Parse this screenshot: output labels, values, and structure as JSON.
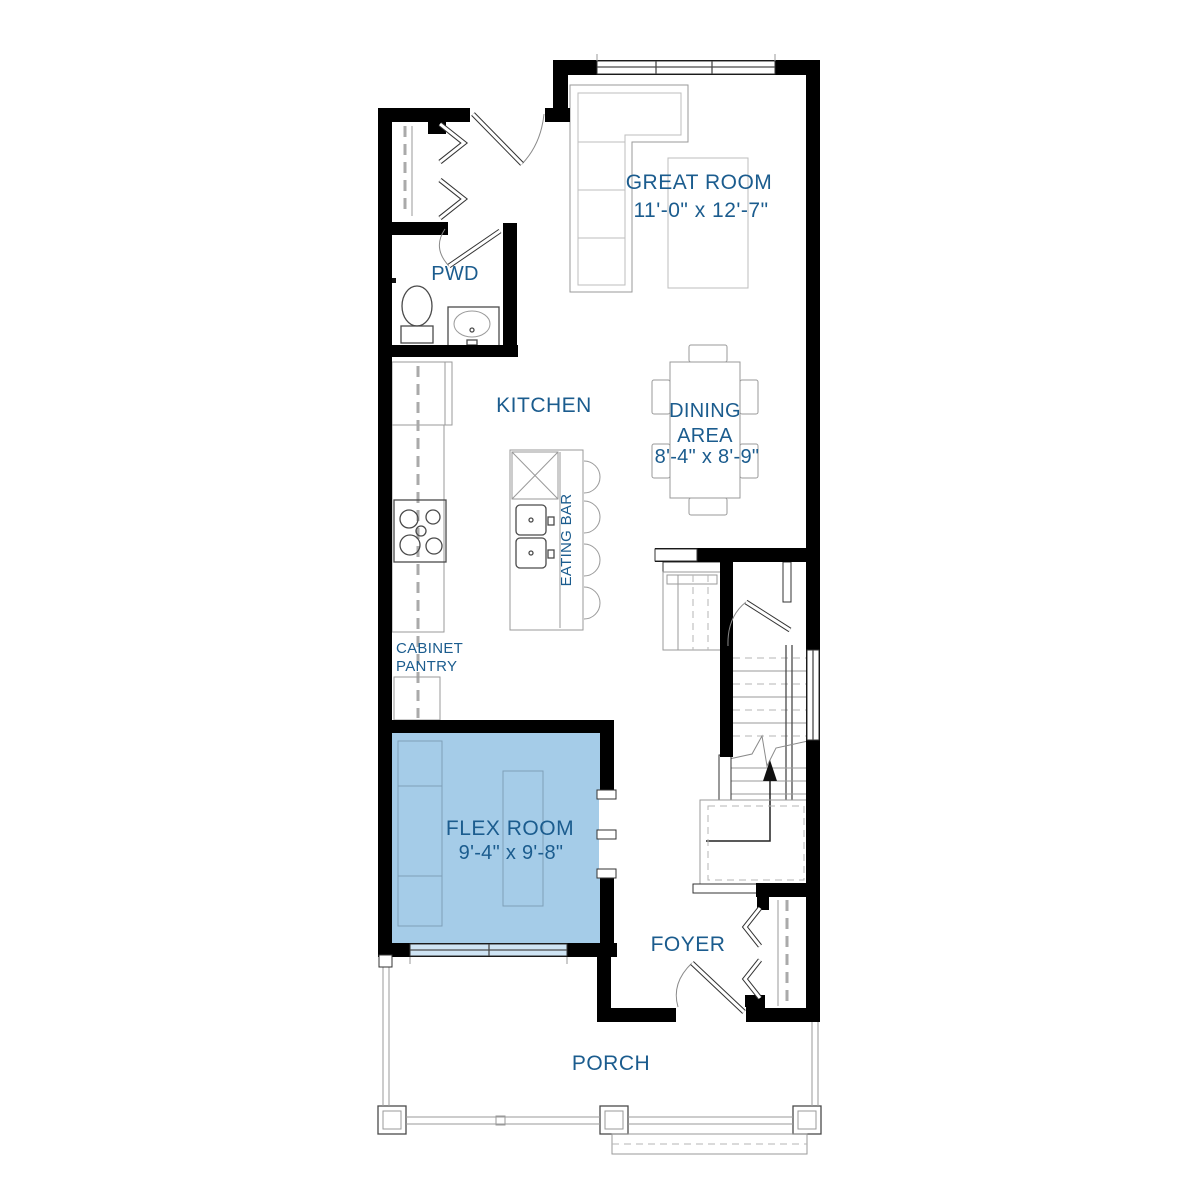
{
  "plan": {
    "rooms": {
      "great_room": {
        "name": "GREAT ROOM",
        "dims": "11'-0\" x 12'-7\""
      },
      "pwd": {
        "name": "PWD"
      },
      "kitchen": {
        "name": "KITCHEN"
      },
      "dining": {
        "line1": "DINING",
        "line2": "AREA",
        "dims": "8'-4\" x 8'-9\""
      },
      "eating_bar": {
        "name": "EATING BAR"
      },
      "pantry": {
        "line1": "CABINET",
        "line2": "PANTRY"
      },
      "flex": {
        "name": "FLEX ROOM",
        "dims": "9'-4\" x 9'-8\""
      },
      "foyer": {
        "name": "FOYER"
      },
      "porch": {
        "name": "PORCH"
      }
    },
    "colors": {
      "label": "#1b5c8e",
      "wall": "#000000",
      "flex_fill": "#a5cce8",
      "flex_window": "#cfe4f4"
    }
  }
}
